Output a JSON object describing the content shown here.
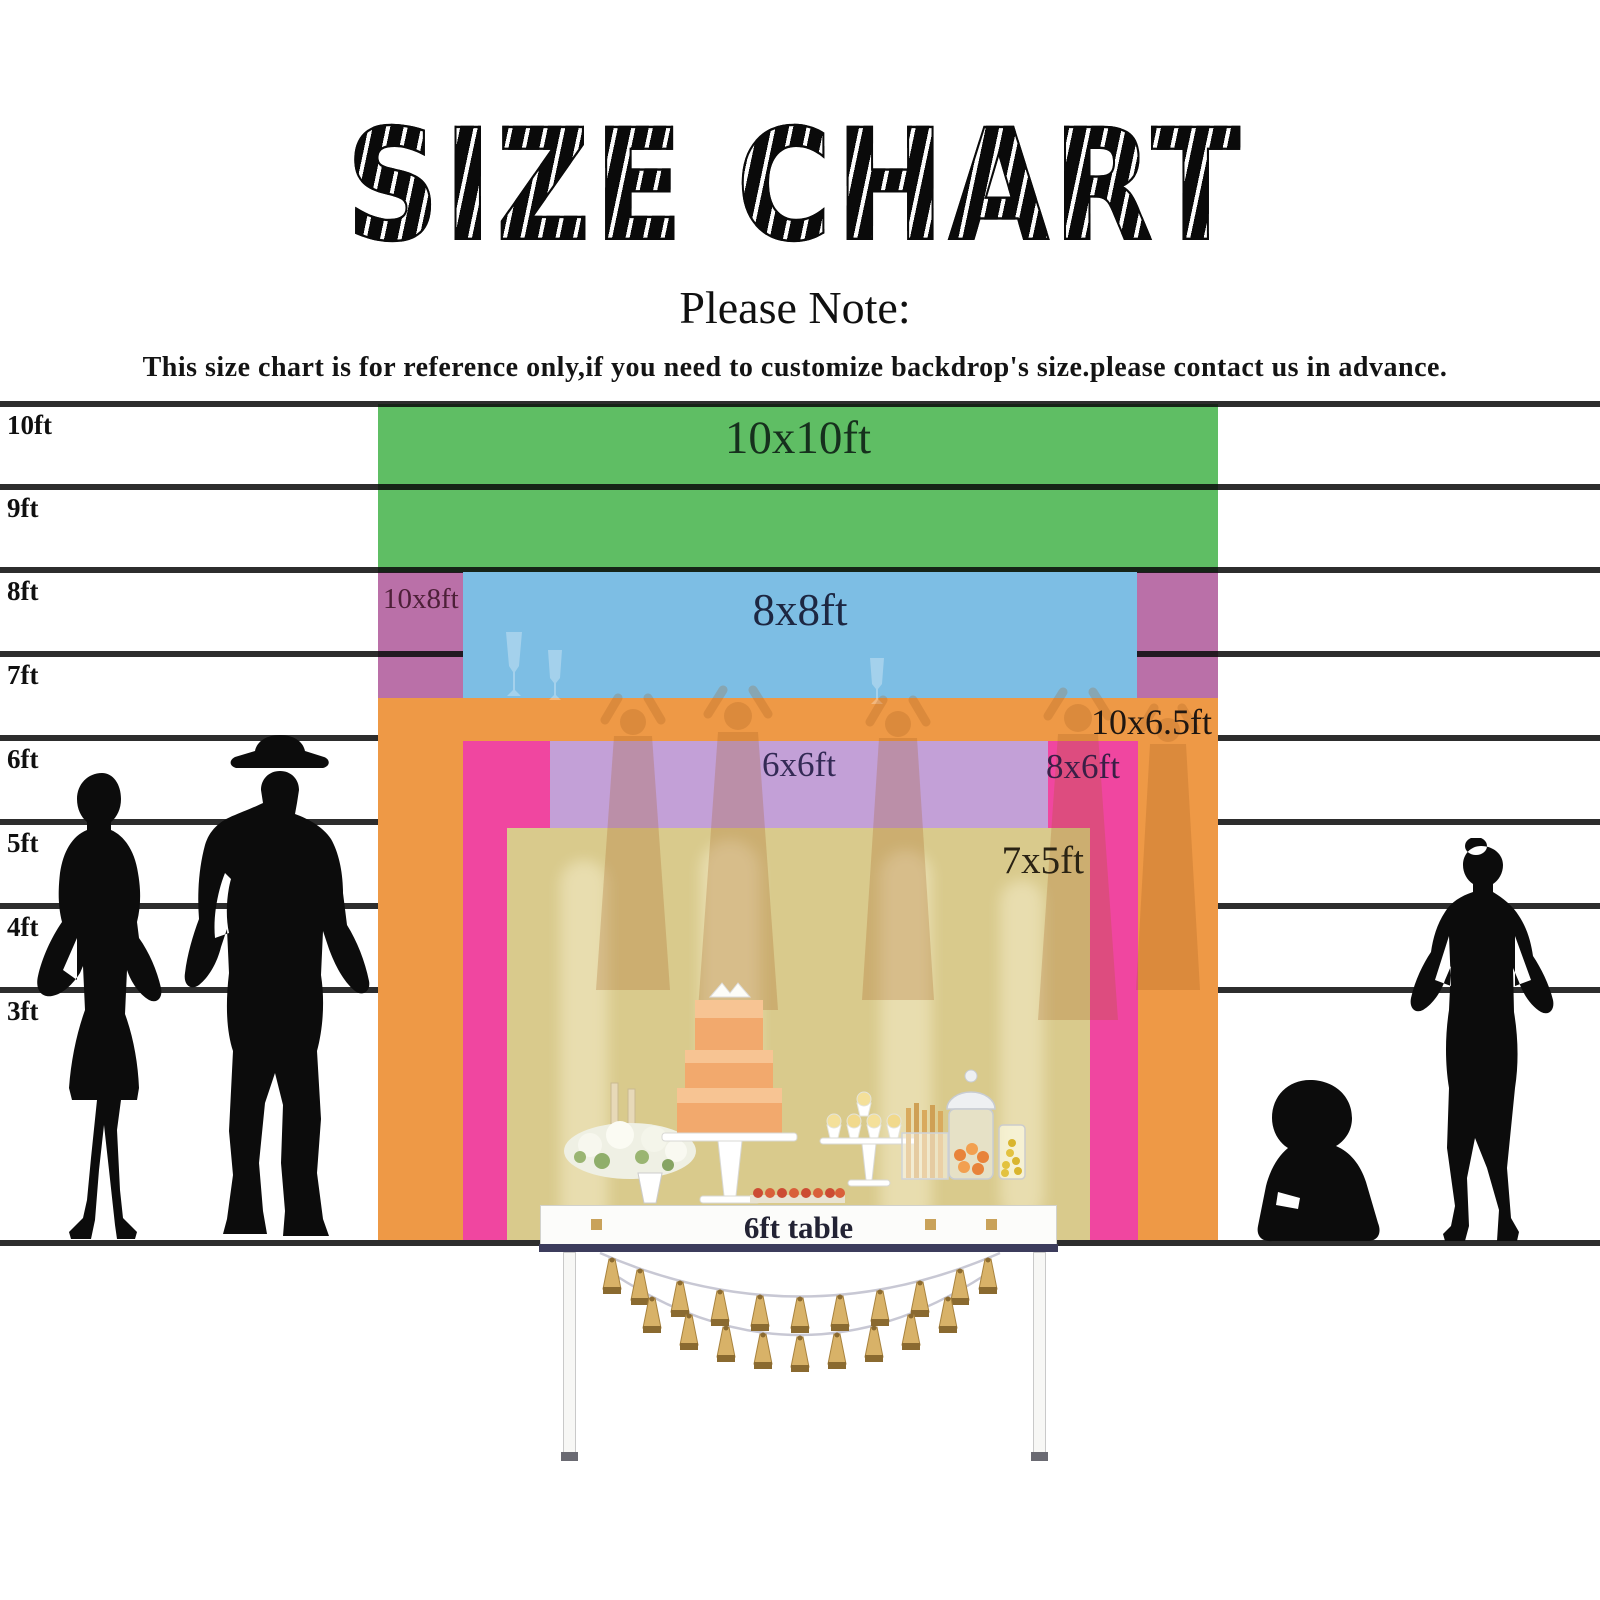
{
  "title": "SIZE CHART",
  "subtitle": "Please Note:",
  "note": "This size chart is for reference only,if you need to customize backdrop's size.please contact us in advance.",
  "ruler": {
    "unit": "ft",
    "labels": [
      "10ft",
      "9ft",
      "8ft",
      "7ft",
      "6ft",
      "5ft",
      "4ft",
      "3ft"
    ]
  },
  "backdrops": [
    {
      "label": "10x10ft",
      "color_key": "green"
    },
    {
      "label": "10x8ft",
      "color_key": "purple"
    },
    {
      "label": "8x8ft",
      "color_key": "blue"
    },
    {
      "label": "10x6.5ft",
      "color_key": "orange"
    },
    {
      "label": "8x6ft",
      "color_key": "pink"
    },
    {
      "label": "6x6ft",
      "color_key": "lilac"
    },
    {
      "label": "7x5ft",
      "color_key": "tan"
    }
  ],
  "table": {
    "label": "6ft table"
  },
  "colors": {
    "green": "#5fbe64",
    "blue": "#7dbee4",
    "purple": "#ba70a8",
    "orange": "#ee9946",
    "pink": "#f046a0",
    "lilac": "#c3a0d7",
    "tan": "#d9ca8c",
    "tassel": "#d8b268",
    "table_edge": "#3c3c5c",
    "line": "#0a0a0a"
  }
}
